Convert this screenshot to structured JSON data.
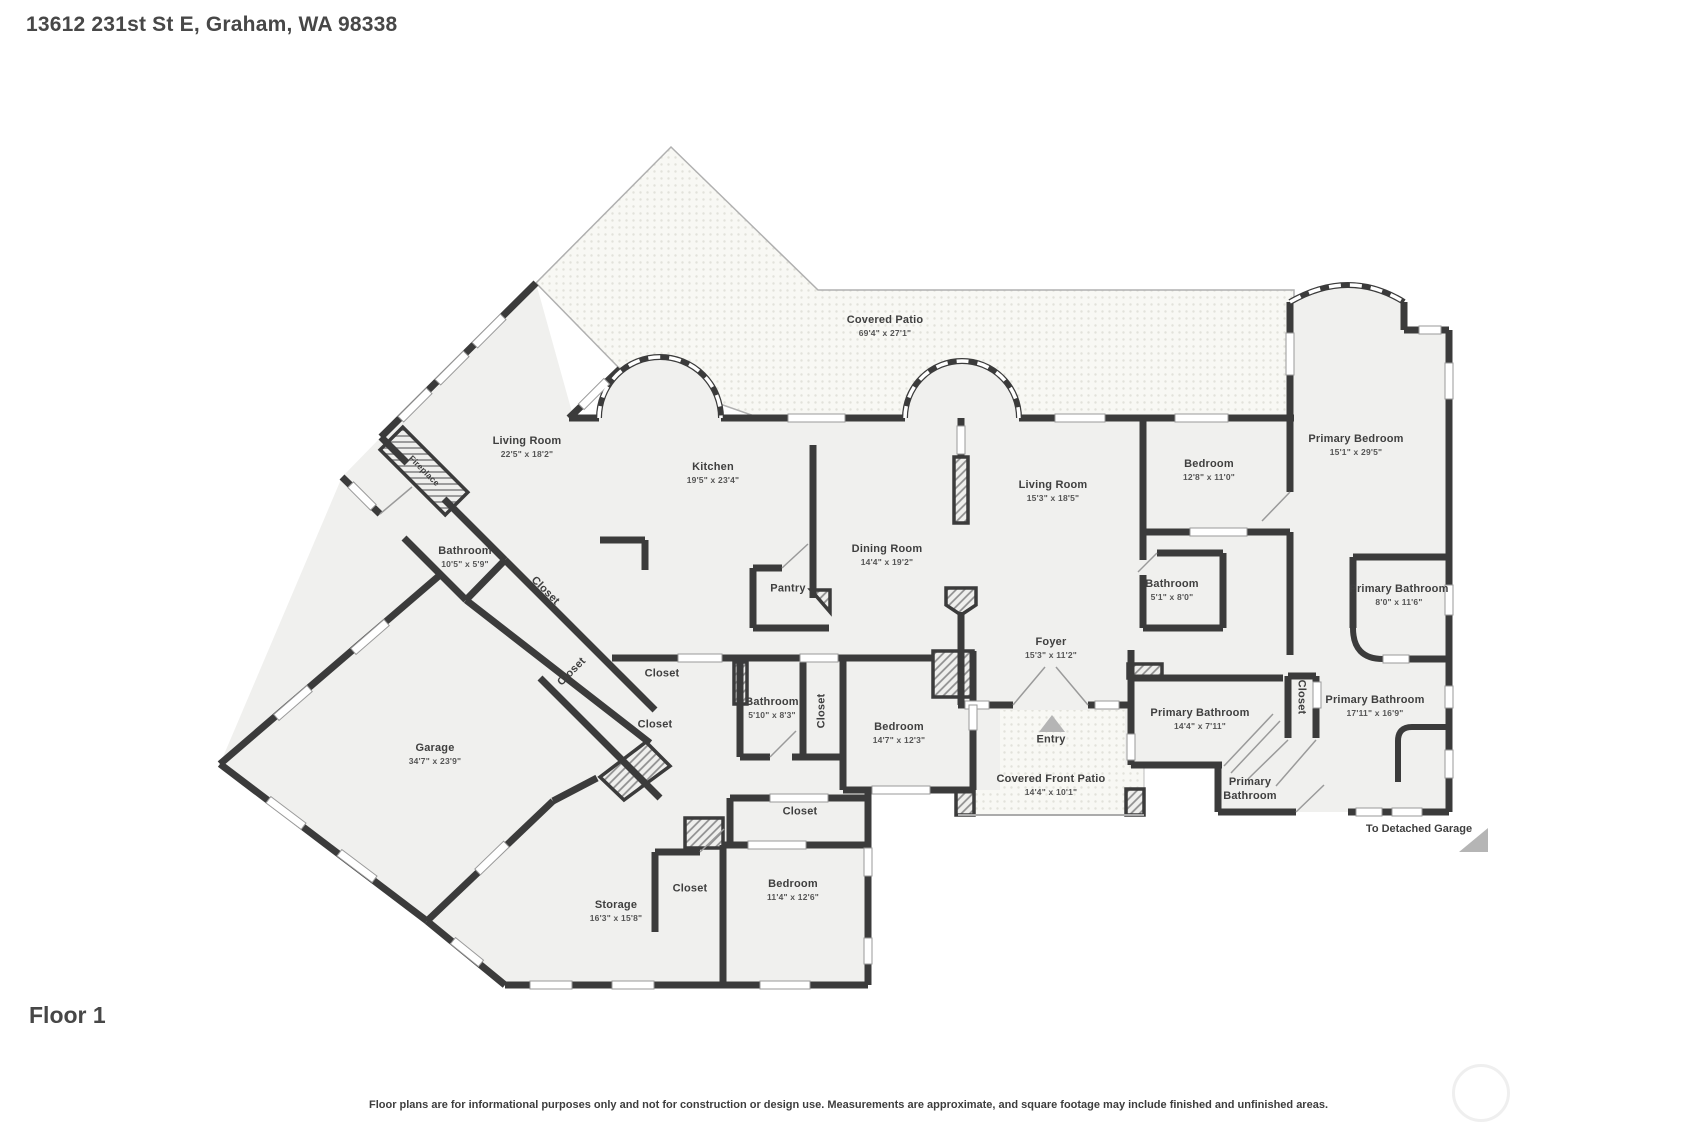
{
  "header": {
    "title": "13612 231st St E, Graham, WA 98338"
  },
  "floor": {
    "label": "Floor 1"
  },
  "annotations": {
    "to_detached_garage": "To Detached Garage"
  },
  "footer": {
    "disclaimer": "Floor plans are for informational purposes only and not for construction or design use. Measurements are approximate, and square footage may include finished and unfinished areas."
  },
  "colors": {
    "wall": "#3b3b3b",
    "floor_fill": "#f0f0ee",
    "patio_fill": "#f8f8f4",
    "patio_dot": "#e2e2db",
    "text": "#3f3f3f",
    "marker": "#b5b5b5"
  },
  "rooms": [
    {
      "id": "covered-patio",
      "name": "Covered Patio",
      "dims": "69'4\" x 27'1\"",
      "x": 885,
      "y": 327,
      "rot": 0
    },
    {
      "id": "living-room-left",
      "name": "Living Room",
      "dims": "22'5\" x 18'2\"",
      "x": 527,
      "y": 448,
      "rot": 0
    },
    {
      "id": "kitchen",
      "name": "Kitchen",
      "dims": "19'5\" x 23'4\"",
      "x": 713,
      "y": 474,
      "rot": 0
    },
    {
      "id": "fireplace",
      "name": "Fireplace",
      "dims": "",
      "x": 424,
      "y": 471,
      "rot": 45,
      "small": true
    },
    {
      "id": "bathroom-left",
      "name": "Bathroom",
      "dims": "10'5\" x 5'9\"",
      "x": 465,
      "y": 558,
      "rot": 0
    },
    {
      "id": "closet-hall-1",
      "name": "Closet",
      "dims": "",
      "x": 545,
      "y": 591,
      "rot": 45
    },
    {
      "id": "closet-hall-2",
      "name": "Closet",
      "dims": "",
      "x": 572,
      "y": 672,
      "rot": -45
    },
    {
      "id": "garage",
      "name": "Garage",
      "dims": "34'7\" x 23'9\"",
      "x": 435,
      "y": 755,
      "rot": 0
    },
    {
      "id": "dining-room",
      "name": "Dining Room",
      "dims": "14'4\" x 19'2\"",
      "x": 887,
      "y": 556,
      "rot": 0
    },
    {
      "id": "pantry",
      "name": "Pantry",
      "dims": "",
      "x": 788,
      "y": 589,
      "rot": 0
    },
    {
      "id": "closet-3",
      "name": "Closet",
      "dims": "",
      "x": 662,
      "y": 674,
      "rot": 0
    },
    {
      "id": "closet-4",
      "name": "Closet",
      "dims": "",
      "x": 655,
      "y": 725,
      "rot": 0
    },
    {
      "id": "living-room-right",
      "name": "Living Room",
      "dims": "15'3\" x 18'5\"",
      "x": 1053,
      "y": 492,
      "rot": 0
    },
    {
      "id": "bedroom-1",
      "name": "Bedroom",
      "dims": "12'8\" x 11'0\"",
      "x": 1209,
      "y": 471,
      "rot": 0
    },
    {
      "id": "bathroom-2",
      "name": "Bathroom",
      "dims": "5'1\" x 8'0\"",
      "x": 1172,
      "y": 591,
      "rot": 0
    },
    {
      "id": "primary-bedroom",
      "name": "Primary Bedroom",
      "dims": "15'1\" x 29'5\"",
      "x": 1356,
      "y": 446,
      "rot": 0
    },
    {
      "id": "primary-bathroom-1",
      "name": "Primary Bathroom",
      "dims": "8'0\" x 11'6\"",
      "x": 1399,
      "y": 596,
      "rot": 0
    },
    {
      "id": "primary-bathroom-2",
      "name": "Primary Bathroom",
      "dims": "17'11\" x 16'9\"",
      "x": 1375,
      "y": 707,
      "rot": 0
    },
    {
      "id": "bathroom-3",
      "name": "Bathroom",
      "dims": "5'10\" x 8'3\"",
      "x": 772,
      "y": 709,
      "rot": 0
    },
    {
      "id": "closet-5",
      "name": "Closet",
      "dims": "",
      "x": 822,
      "y": 711,
      "rot": -90
    },
    {
      "id": "bedroom-2",
      "name": "Bedroom",
      "dims": "14'7\" x 12'3\"",
      "x": 899,
      "y": 734,
      "rot": 0
    },
    {
      "id": "foyer",
      "name": "Foyer",
      "dims": "15'3\" x 11'2\"",
      "x": 1051,
      "y": 649,
      "rot": 0
    },
    {
      "id": "entry",
      "name": "Entry",
      "dims": "",
      "x": 1051,
      "y": 740,
      "rot": 0
    },
    {
      "id": "covered-front-patio",
      "name": "Covered Front Patio",
      "dims": "14'4\" x 10'1\"",
      "x": 1051,
      "y": 786,
      "rot": 0
    },
    {
      "id": "primary-bathroom-3",
      "name": "Primary Bathroom",
      "dims": "14'4\" x 7'11\"",
      "x": 1200,
      "y": 720,
      "rot": 0
    },
    {
      "id": "primary-bathroom-4",
      "name": "Primary Bathroom",
      "dims": "",
      "x": 1250,
      "y": 789,
      "rot": 0,
      "wrap": true
    },
    {
      "id": "closet-6",
      "name": "Closet",
      "dims": "",
      "x": 1301,
      "y": 697,
      "rot": 90
    },
    {
      "id": "closet-7",
      "name": "Closet",
      "dims": "",
      "x": 800,
      "y": 812,
      "rot": 0
    },
    {
      "id": "bedroom-3",
      "name": "Bedroom",
      "dims": "11'4\" x 12'6\"",
      "x": 793,
      "y": 891,
      "rot": 0
    },
    {
      "id": "closet-8",
      "name": "Closet",
      "dims": "",
      "x": 690,
      "y": 889,
      "rot": 0
    },
    {
      "id": "storage",
      "name": "Storage",
      "dims": "16'3\" x 15'8\"",
      "x": 616,
      "y": 912,
      "rot": 0
    }
  ]
}
